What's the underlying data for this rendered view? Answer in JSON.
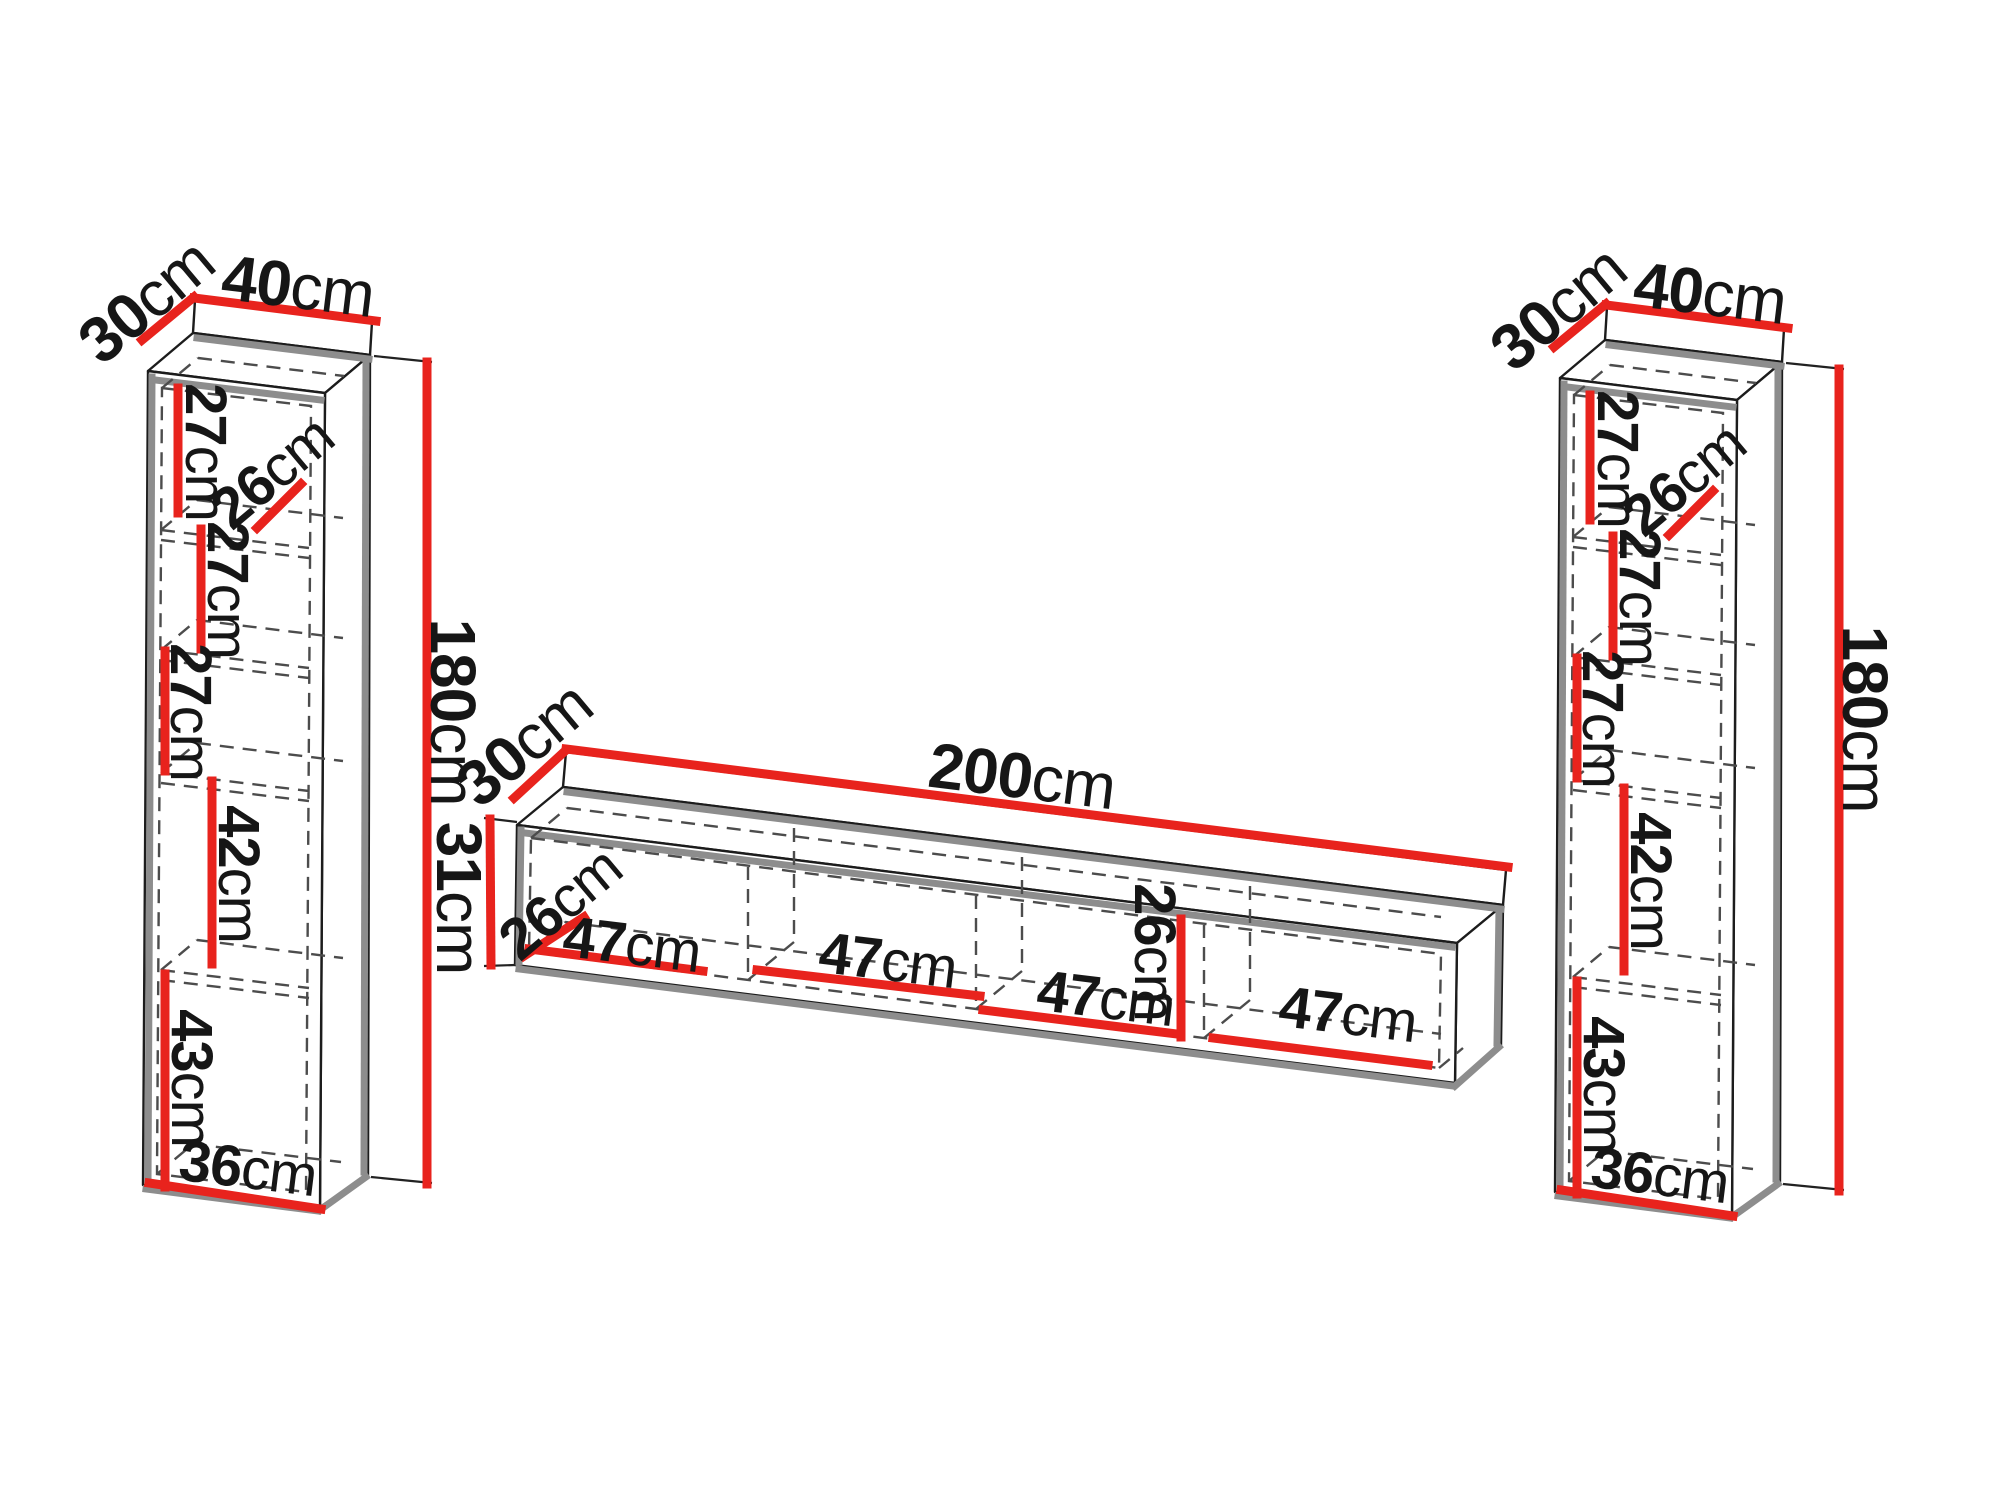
{
  "diagram": {
    "colors": {
      "dimension_line": "#e8231d",
      "outline": "#1c1c1c",
      "shadow_edge": "#8d8d8d",
      "hidden_edge": "#4c4c4c",
      "label_text": "#161616",
      "background": "#ffffff"
    },
    "pieces": {
      "left_cabinet": {
        "dims": {
          "depth": {
            "value": "30",
            "unit": "cm"
          },
          "width": {
            "value": "40",
            "unit": "cm"
          },
          "height": {
            "value": "180",
            "unit": "cm"
          },
          "shelf1": {
            "value": "27",
            "unit": "cm"
          },
          "inner_depth": {
            "value": "26",
            "unit": "cm"
          },
          "shelf2": {
            "value": "27",
            "unit": "cm"
          },
          "shelf3": {
            "value": "27",
            "unit": "cm"
          },
          "shelf4": {
            "value": "42",
            "unit": "cm"
          },
          "shelf5": {
            "value": "43",
            "unit": "cm"
          },
          "inner_width": {
            "value": "36",
            "unit": "cm"
          }
        }
      },
      "tv_stand": {
        "dims": {
          "depth": {
            "value": "30",
            "unit": "cm"
          },
          "width": {
            "value": "200",
            "unit": "cm"
          },
          "height": {
            "value": "31",
            "unit": "cm"
          },
          "inner_depth": {
            "value": "26",
            "unit": "cm"
          },
          "bay1": {
            "value": "47",
            "unit": "cm"
          },
          "bay2": {
            "value": "47",
            "unit": "cm"
          },
          "bay3": {
            "value": "47",
            "unit": "cm"
          },
          "inner_height": {
            "value": "26",
            "unit": "cm"
          },
          "bay4": {
            "value": "47",
            "unit": "cm"
          }
        }
      },
      "right_cabinet": {
        "dims": {
          "depth": {
            "value": "30",
            "unit": "cm"
          },
          "width": {
            "value": "40",
            "unit": "cm"
          },
          "height": {
            "value": "180",
            "unit": "cm"
          },
          "shelf1": {
            "value": "27",
            "unit": "cm"
          },
          "inner_depth": {
            "value": "26",
            "unit": "cm"
          },
          "shelf2": {
            "value": "27",
            "unit": "cm"
          },
          "shelf3": {
            "value": "27",
            "unit": "cm"
          },
          "shelf4": {
            "value": "42",
            "unit": "cm"
          },
          "shelf5": {
            "value": "43",
            "unit": "cm"
          },
          "inner_width": {
            "value": "36",
            "unit": "cm"
          }
        }
      }
    }
  }
}
